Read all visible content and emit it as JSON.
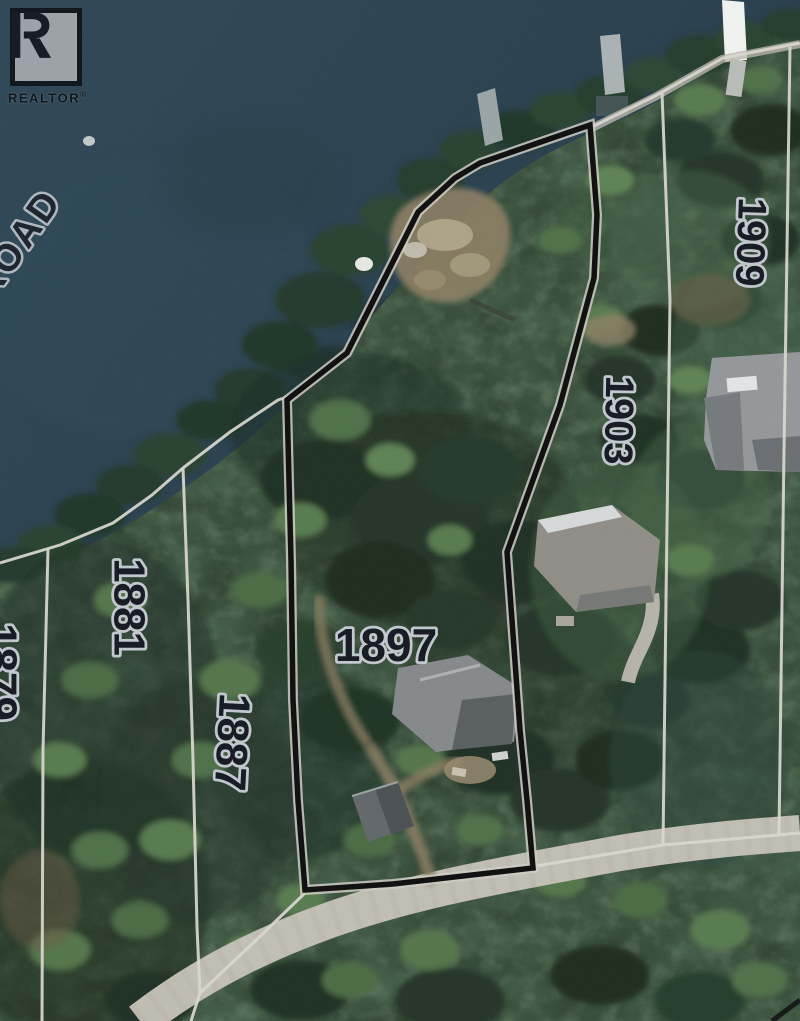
{
  "branding": {
    "logo_letter": "R",
    "logo_label": "REALTOR",
    "logo_reg": "®"
  },
  "map": {
    "type": "aerial-parcel-map",
    "road_label": "ROAD",
    "subject_parcel": "1897",
    "lot_labels": [
      {
        "id": "lot-1897",
        "text": "1897"
      },
      {
        "id": "lot-1903",
        "text": "1903"
      },
      {
        "id": "lot-1909",
        "text": "1909"
      },
      {
        "id": "lot-1881",
        "text": "1881"
      },
      {
        "id": "lot-1887",
        "text": "1887"
      },
      {
        "id": "lot-1879-partial",
        "text": "1879"
      }
    ],
    "colors": {
      "water": "#2a4150",
      "forest": "#2c3f2d",
      "boundary": "#0b0b0b",
      "lot_line": "#dbd9d0",
      "road": "#c9c5ba",
      "label_fill": "#12161f",
      "label_halo": "#c3c8cf"
    }
  }
}
